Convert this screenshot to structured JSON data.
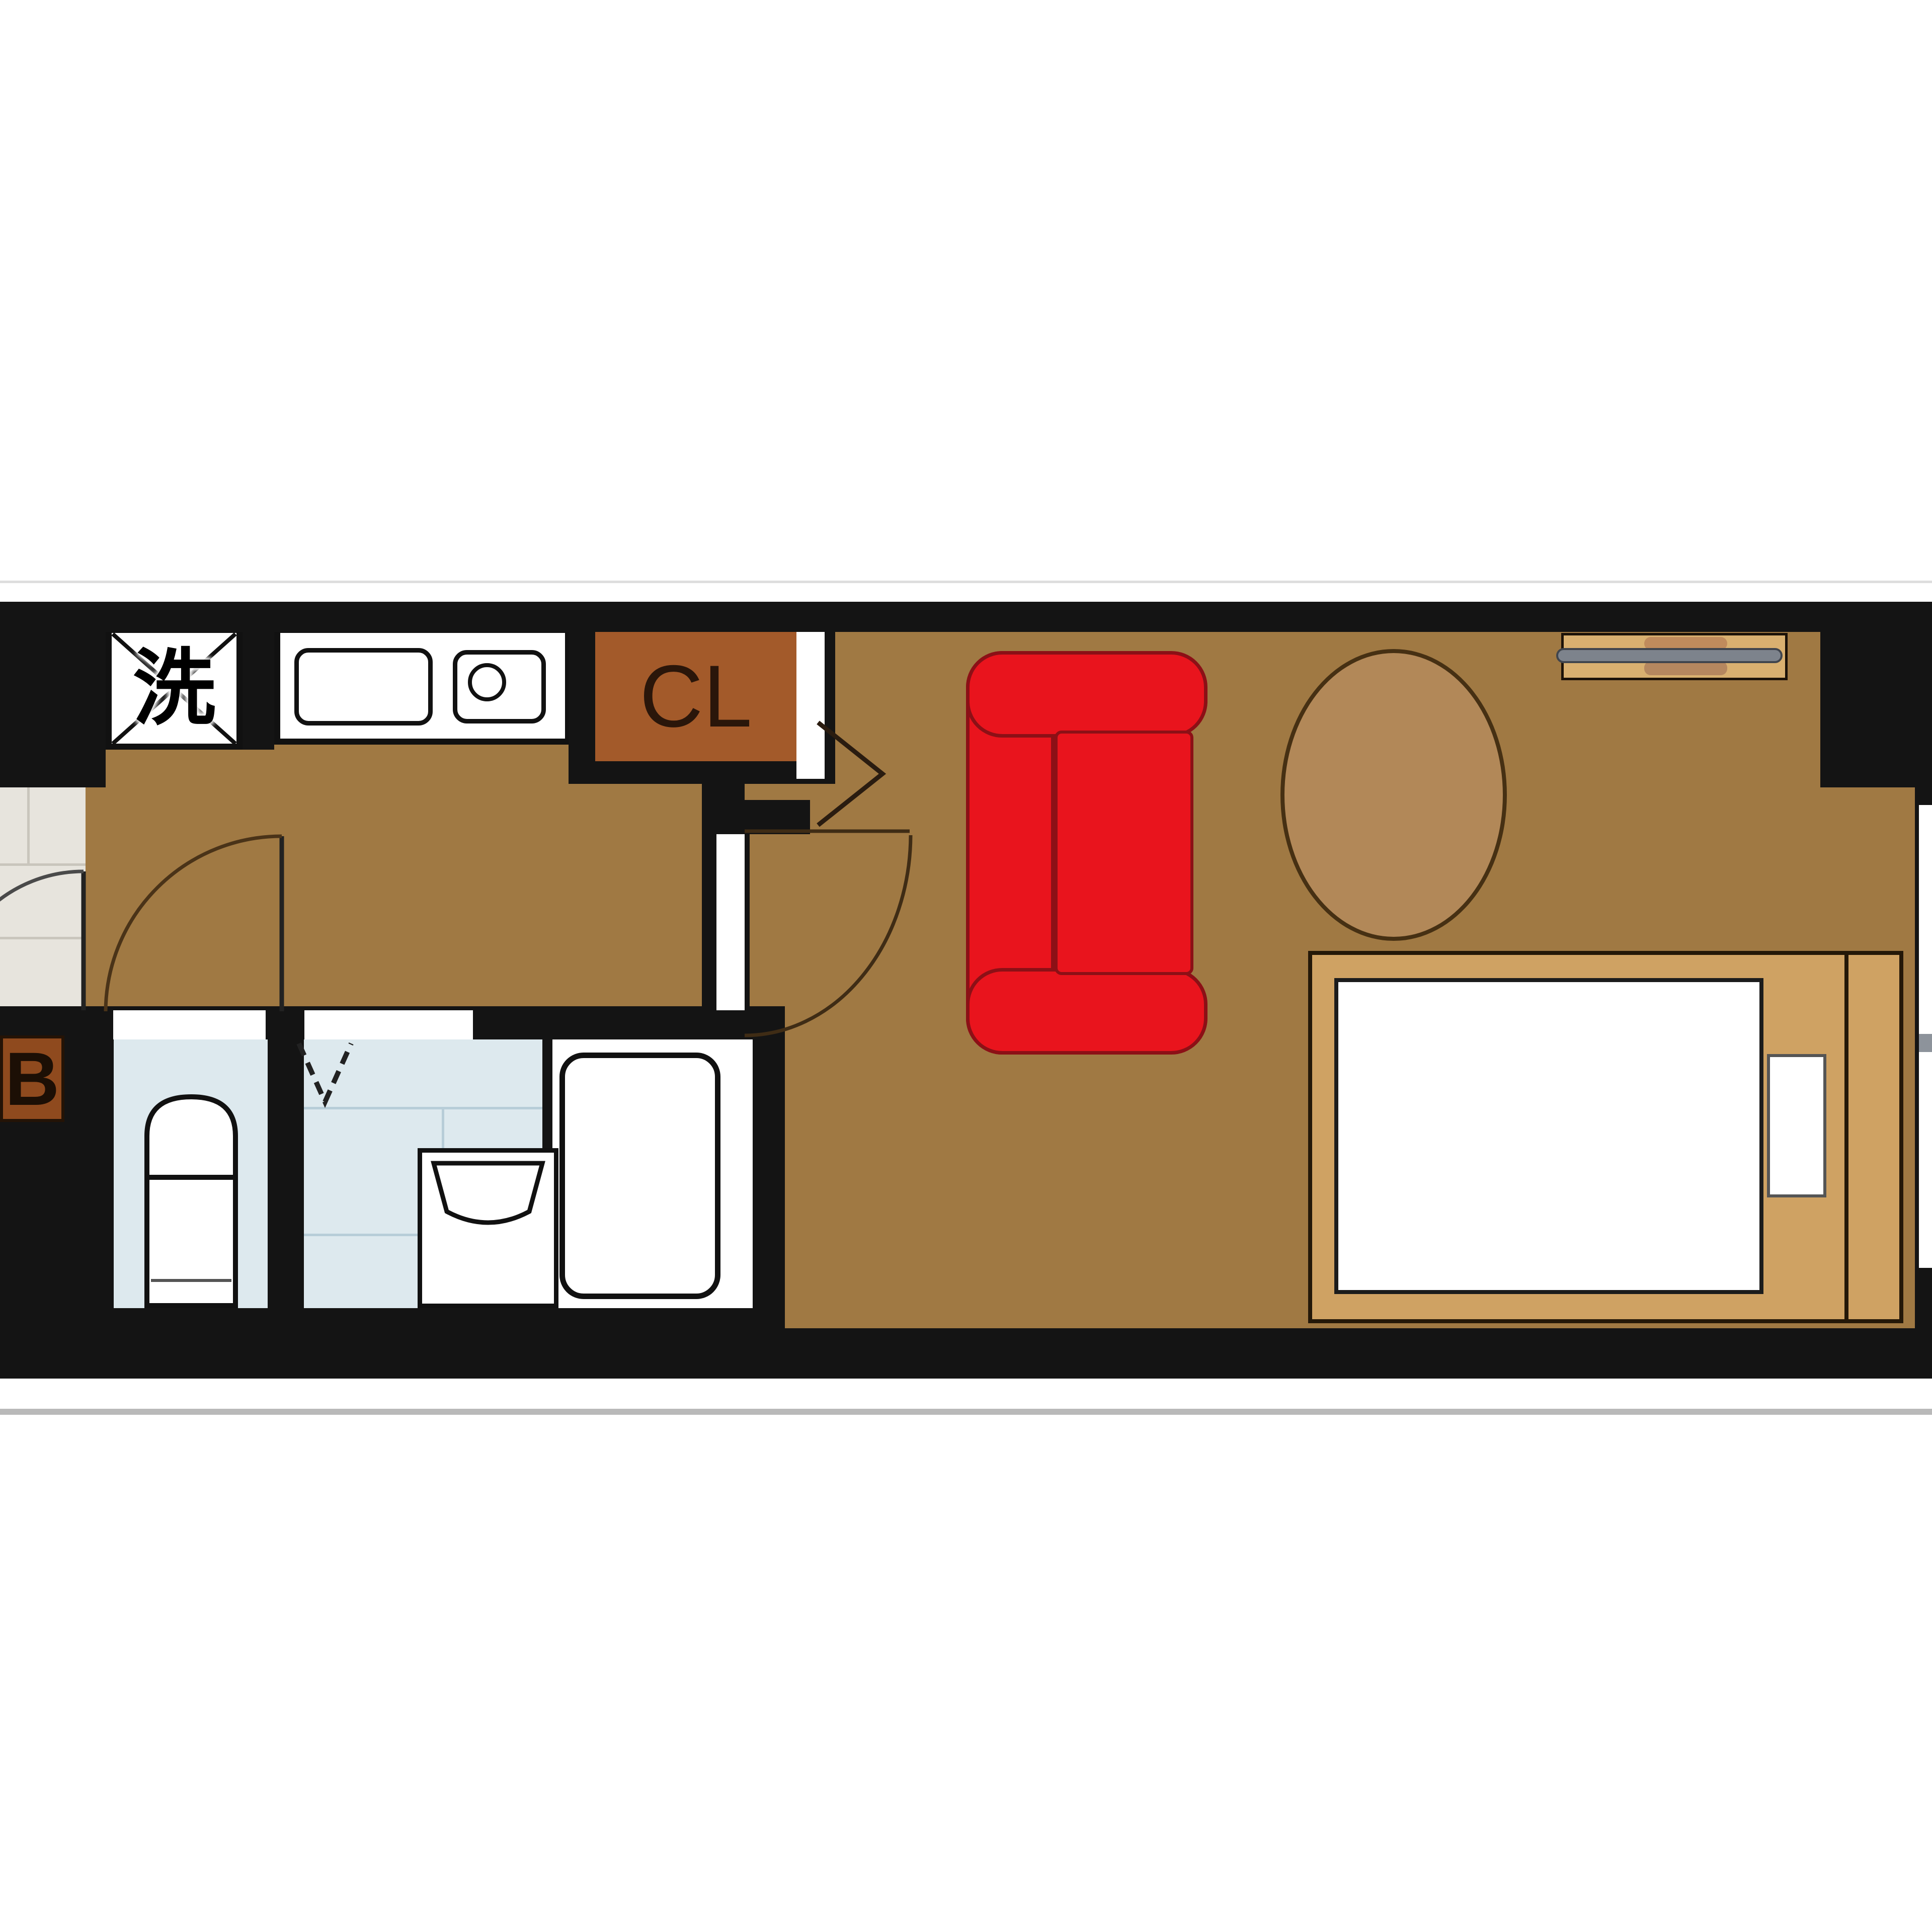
{
  "title": "studio-apartment-floor-plan",
  "labels": {
    "washer": "洗",
    "closet": "CL",
    "bath": "B"
  },
  "colors": {
    "wall": "#141414",
    "wood_floor": "#a07943",
    "genkan_tile": "#e7e4dd",
    "wet_room_blue": "#dde9ee",
    "closet_brown": "#a35a2a",
    "bath_label_brown": "#8f4a1e",
    "sofa_red": "#e9141d",
    "sofa_outline": "#8c1016",
    "table_fill": "#b28858",
    "bed_frame_tan": "#cfa263",
    "tv_board_tan": "#d9b070",
    "tv_gray": "#7d838c",
    "fixture_white": "#ffffff"
  },
  "rooms": [
    {
      "name": "genkan-entrance",
      "floor": "tile"
    },
    {
      "name": "kitchen-corridor",
      "floor": "wood",
      "fixtures": [
        "washing-machine-space",
        "kitchen-sink",
        "single-burner-stove"
      ]
    },
    {
      "name": "closet",
      "label": "CL"
    },
    {
      "name": "toilet-room",
      "fixtures": [
        "toilet"
      ]
    },
    {
      "name": "unit-bath",
      "label": "B",
      "fixtures": [
        "bathtub",
        "vanity-sink"
      ]
    },
    {
      "name": "living-room",
      "floor": "wood",
      "furniture": [
        "sofa",
        "oval-table",
        "tv-board",
        "single-bed"
      ]
    }
  ],
  "furniture": [
    {
      "name": "sofa",
      "color": "#e9141d",
      "position": "living-room-left"
    },
    {
      "name": "oval-table",
      "color": "#b28858",
      "position": "living-room-center"
    },
    {
      "name": "tv-board",
      "color": "#d9b070",
      "position": "living-room-top-right"
    },
    {
      "name": "single-bed",
      "color": "#cfa263",
      "mattress": "#ffffff",
      "position": "living-room-bottom-right"
    }
  ],
  "doors": [
    {
      "name": "entry-door",
      "type": "swing",
      "location": "genkan"
    },
    {
      "name": "bathroom-door",
      "type": "swing",
      "location": "corridor"
    },
    {
      "name": "living-room-door",
      "type": "swing",
      "location": "corridor-living-boundary"
    },
    {
      "name": "closet-door",
      "type": "folding",
      "location": "closet-right"
    },
    {
      "name": "bath-inner-door",
      "type": "folding",
      "location": "unit-bath"
    }
  ]
}
